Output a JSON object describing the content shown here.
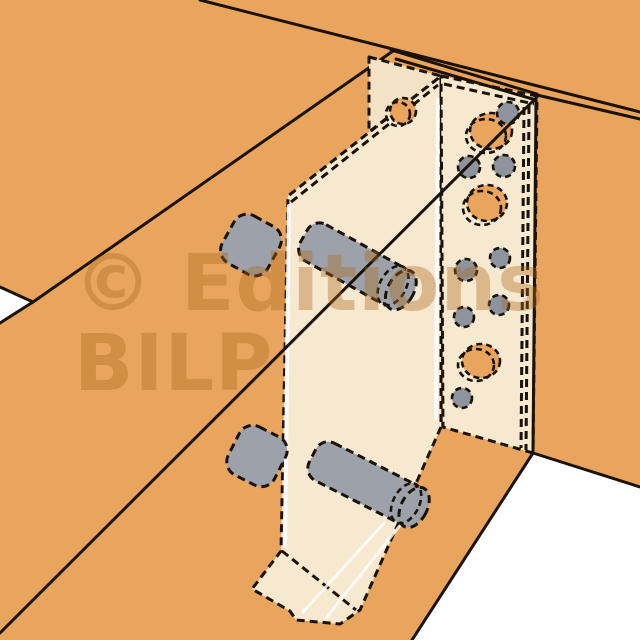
{
  "watermark": {
    "line1": "© Editions",
    "line2": "BILP"
  },
  "colors": {
    "wood": "#E9A55E",
    "bracket": "#F7E8D0",
    "bracket_shaded": "#F4E2C6",
    "dowel": "#9DA2AA",
    "pin": "#8E949D",
    "line": "#1A1208",
    "background": "#FFFFFF",
    "watermark": "rgba(170,105,30,0.38)"
  }
}
